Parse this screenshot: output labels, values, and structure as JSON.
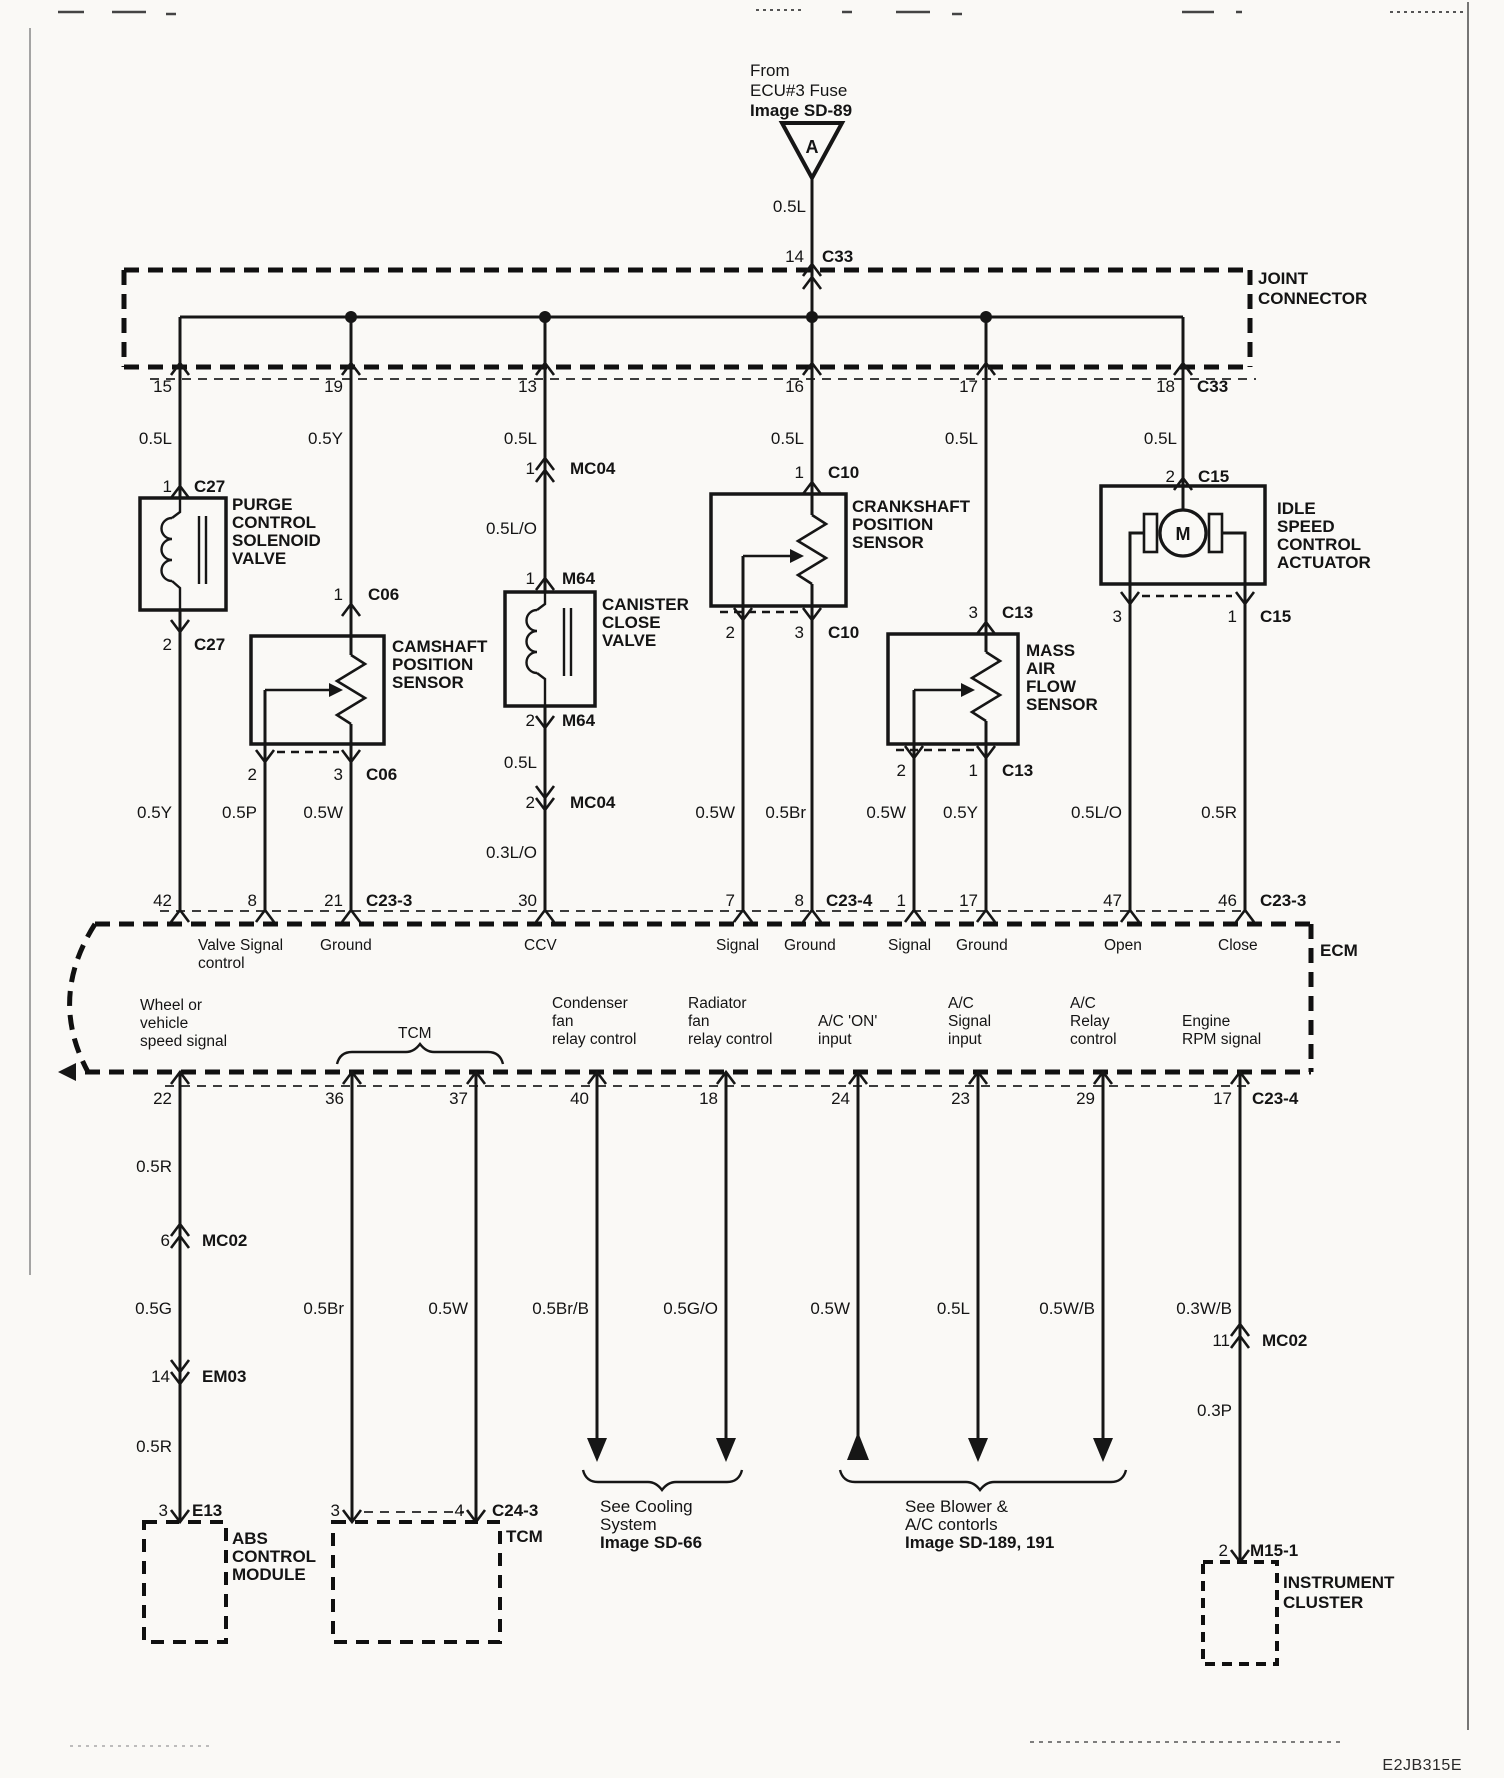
{
  "page": {
    "code": "E2JB315E"
  },
  "source": {
    "l1": "From",
    "l2": "ECU#3 Fuse",
    "l3": "Image SD-89",
    "tag": "A",
    "wire": "0.5L",
    "pin": "14",
    "conn": "C33"
  },
  "joint": {
    "l1": "JOINT",
    "l2": "CONNECTOR",
    "p15": "15",
    "p19": "19",
    "p13": "13",
    "p16": "16",
    "p17": "17",
    "p18": "18",
    "conn": "C33",
    "w1": "0.5L",
    "w2": "0.5Y",
    "w3": "0.5L",
    "w4": "0.5L",
    "w5": "0.5L",
    "w6": "0.5L"
  },
  "purge": {
    "pin_in": "1",
    "conn_in": "C27",
    "n1": "PURGE",
    "n2": "CONTROL",
    "n3": "SOLENOID",
    "n4": "VALVE",
    "pin_out": "2",
    "conn_out": "C27",
    "wire_out": "0.5Y",
    "ecm_pin": "42"
  },
  "camshaft": {
    "pin_in": "1",
    "conn_in": "C06",
    "n1": "CAMSHAFT",
    "n2": "POSITION",
    "n3": "SENSOR",
    "out1": "2",
    "out2": "3",
    "conn_out": "C06",
    "w1": "0.5P",
    "w2": "0.5W",
    "ecm1": "8",
    "ecm2": "21",
    "ecm_conn": "C23-3"
  },
  "canister": {
    "c1_pin": "1",
    "c1": "MC04",
    "w1": "0.5L/O",
    "c2_pin": "1",
    "c2": "M64",
    "n1": "CANISTER",
    "n2": "CLOSE",
    "n3": "VALVE",
    "out_pin": "2",
    "out_conn": "M64",
    "w2": "0.5L",
    "c3_pin": "2",
    "c3": "MC04",
    "w3": "0.3L/O",
    "ecm_pin": "30"
  },
  "crankshaft": {
    "pin_in": "1",
    "conn_in": "C10",
    "n1": "CRANKSHAFT",
    "n2": "POSITION",
    "n3": "SENSOR",
    "out1": "2",
    "out2": "3",
    "conn_out": "C10",
    "w1": "0.5W",
    "w2": "0.5Br",
    "ecm1": "7",
    "ecm2": "8",
    "ecm_conn": "C23-4"
  },
  "maf": {
    "pin_in": "3",
    "conn_in": "C13",
    "n1": "MASS",
    "n2": "AIR",
    "n3": "FLOW",
    "n4": "SENSOR",
    "out1": "2",
    "out2": "1",
    "conn_out": "C13",
    "w1": "0.5W",
    "w2": "0.5Y",
    "ecm1": "1",
    "ecm2": "17"
  },
  "isc": {
    "pin_in": "2",
    "conn_in": "C15",
    "n1": "IDLE",
    "n2": "SPEED",
    "n3": "CONTROL",
    "n4": "ACTUATOR",
    "motor": "M",
    "out1": "3",
    "out2": "1",
    "conn_out": "C15",
    "w1": "0.5L/O",
    "w2": "0.5R",
    "ecm1": "47",
    "ecm2": "46",
    "ecm_conn": "C23-3"
  },
  "ecm": {
    "label": "ECM",
    "fn": {
      "valve1": "Valve",
      "valve2": "control",
      "sig1": "Signal",
      "gnd1": "Ground",
      "ccv": "CCV",
      "sig2": "Signal",
      "gnd2": "Ground",
      "sig3": "Signal",
      "gnd3": "Ground",
      "open": "Open",
      "close": "Close"
    },
    "out": {
      "wheel1": "Wheel or",
      "wheel2": "vehicle",
      "wheel3": "speed signal",
      "tcm": "TCM",
      "cond1": "Condenser",
      "cond2": "fan",
      "cond3": "relay control",
      "rad1": "Radiator",
      "rad2": "fan",
      "rad3": "relay control",
      "acon1": "A/C 'ON'",
      "acon2": "input",
      "acsig1": "A/C",
      "acsig2": "Signal",
      "acsig3": "input",
      "acrel1": "A/C",
      "acrel2": "Relay",
      "acrel3": "control",
      "rpm1": "Engine",
      "rpm2": "RPM signal"
    },
    "bp": {
      "p22": "22",
      "p36": "36",
      "p37": "37",
      "p40": "40",
      "p18": "18",
      "p24": "24",
      "p23": "23",
      "p29": "29",
      "p17": "17",
      "conn": "C23-4"
    }
  },
  "lower": {
    "wheel": {
      "w1": "0.5R",
      "c1_pin": "6",
      "c1": "MC02",
      "w2": "0.5G",
      "c2_pin": "14",
      "c2": "EM03",
      "w3": "0.5R",
      "pin": "3",
      "conn": "E13"
    },
    "abs": {
      "n1": "ABS",
      "n2": "CONTROL",
      "n3": "MODULE"
    },
    "tcm": {
      "w1": "0.5Br",
      "w2": "0.5W",
      "pin1": "3",
      "pin2": "4",
      "conn": "C24-3",
      "label": "TCM"
    },
    "cooling": {
      "w1": "0.5Br/B",
      "w2": "0.5G/O",
      "n1": "See Cooling",
      "n2": "System",
      "n3": "Image SD-66"
    },
    "blower": {
      "w1": "0.5W",
      "w2": "0.5L",
      "w3": "0.5W/B",
      "n1": "See Blower &",
      "n2": "A/C contorls",
      "n3": "Image SD-189, 191"
    },
    "rpm": {
      "w1": "0.3W/B",
      "c1_pin": "11",
      "c1": "MC02",
      "w2": "0.3P",
      "pin": "2",
      "conn": "M15-1"
    },
    "cluster": {
      "n1": "INSTRUMENT",
      "n2": "CLUSTER"
    }
  }
}
